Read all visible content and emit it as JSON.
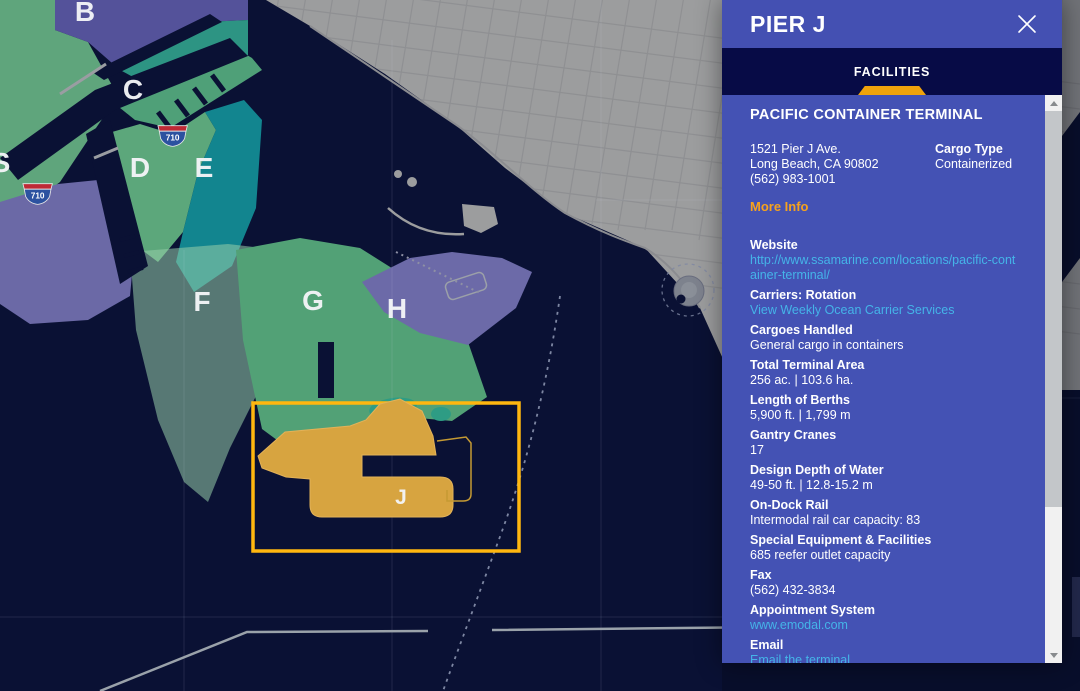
{
  "map": {
    "pier_labels": [
      {
        "text": "B"
      },
      {
        "text": "C"
      },
      {
        "text": "D"
      },
      {
        "text": "E"
      },
      {
        "text": "F"
      },
      {
        "text": "G"
      },
      {
        "text": "H"
      },
      {
        "text": "S"
      },
      {
        "text": "J"
      }
    ],
    "highway_shields": [
      {
        "label": "710"
      },
      {
        "label": "710"
      }
    ],
    "selected_pier": "J",
    "colors": {
      "water": "#0A1134",
      "city": "#9C9D9E",
      "pier_green": "#52A176",
      "pier_teal": "#12858F",
      "pier_purple": "#6B69A6",
      "pier_gold": "#D7A440",
      "highlight_gold": "#FFB70F"
    }
  },
  "panel": {
    "title": "PIER J",
    "tab": {
      "label": "FACILITIES"
    },
    "accent_orange": "#F0A30B",
    "link_blue": "#45B4E8",
    "terminal": {
      "name": "PACIFIC CONTAINER TERMINAL",
      "address_line1": "1521 Pier J Ave.",
      "address_line2": "Long Beach, CA 90802",
      "phone": "(562) 983-1001",
      "cargo_type_label": "Cargo Type",
      "cargo_type": "Containerized",
      "more_info": "More Info",
      "facts": [
        {
          "label": "Website",
          "value": "http://www.ssamarine.com/locations/pacific-container-terminal/"
        },
        {
          "label": "Carriers: Rotation",
          "value": "View Weekly Ocean Carrier Services"
        },
        {
          "label": "Cargoes Handled",
          "value": "General cargo in containers"
        },
        {
          "label": "Total Terminal Area",
          "value": "256 ac. | 103.6 ha."
        },
        {
          "label": "Length of Berths",
          "value": "5,900 ft. | 1,799 m"
        },
        {
          "label": "Gantry Cranes",
          "value": "17"
        },
        {
          "label": "Design Depth of Water",
          "value": "49-50 ft. | 12.8-15.2 m"
        },
        {
          "label": "On-Dock Rail",
          "value": "Intermodal rail car capacity: 83"
        },
        {
          "label": "Special Equipment & Facilities",
          "value": "685 reefer outlet capacity"
        },
        {
          "label": "Fax",
          "value": "(562) 432-3834"
        },
        {
          "label": "Appointment System",
          "value": "www.emodal.com"
        },
        {
          "label": "Email",
          "value": "Email the terminal"
        }
      ]
    }
  }
}
